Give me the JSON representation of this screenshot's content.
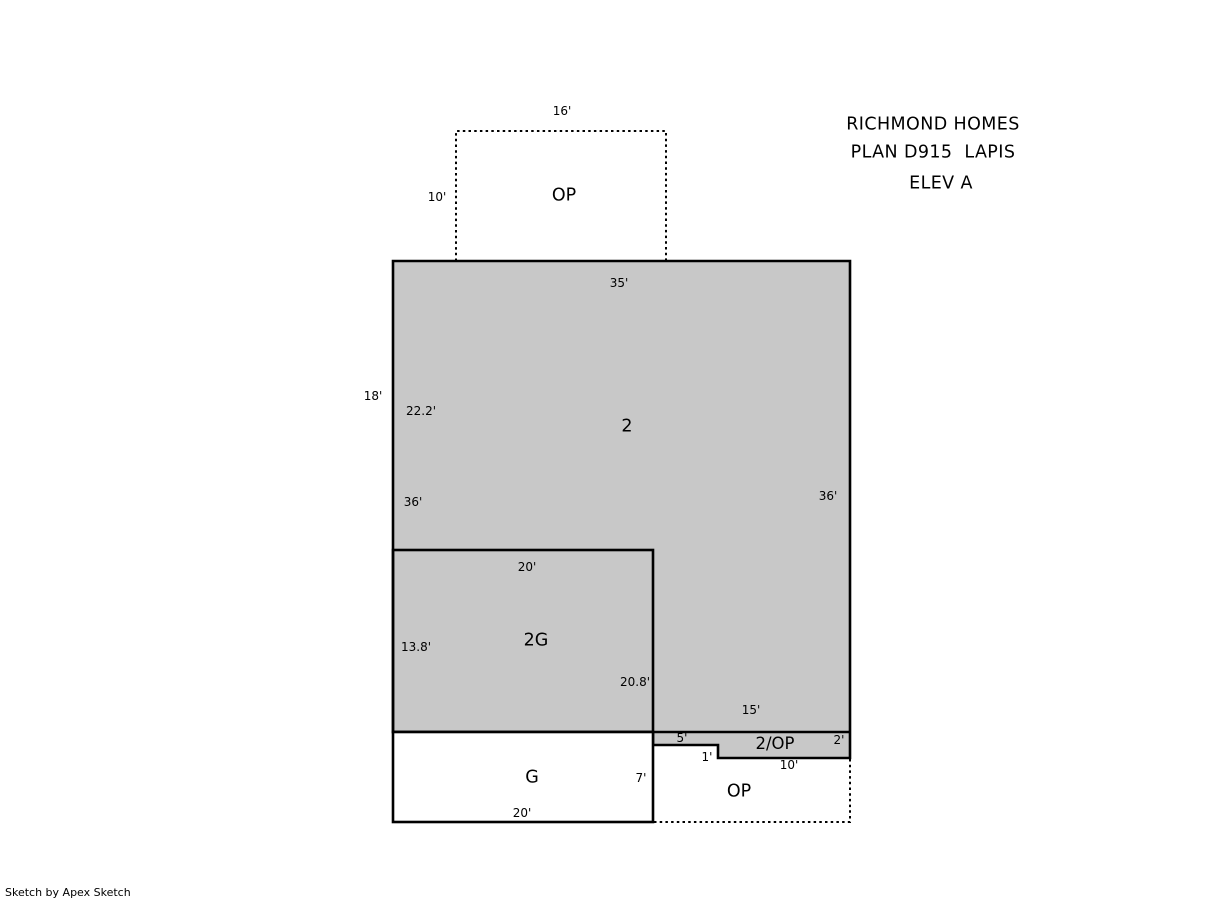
{
  "title": {
    "line1": "RICHMOND HOMES",
    "line2": "PLAN D915  LAPIS",
    "line3": "ELEV A"
  },
  "footer": {
    "credit": "Sketch by Apex Sketch"
  },
  "colors": {
    "area_fill": "#c8c8c8",
    "outline": "#000000",
    "background": "#ffffff"
  },
  "areas": {
    "op_top": {
      "label": "OP",
      "width": "16'",
      "height": "10'"
    },
    "second_floor": {
      "label": "2",
      "top": "35'",
      "left_outer": "18'",
      "left_upper": "22.2'",
      "left_total": "36'",
      "right": "36'"
    },
    "second_garage": {
      "label": "2G",
      "top": "20'",
      "left": "13.8'",
      "right": "20.8'"
    },
    "garage": {
      "label": "G",
      "right": "7'",
      "bottom": "20'"
    },
    "strip_2op": {
      "label": "2/OP",
      "top": "15'",
      "seg_left": "5'",
      "notch": "1'",
      "bottom": "10'",
      "right": "2'"
    },
    "op_bottom": {
      "label": "OP"
    }
  }
}
